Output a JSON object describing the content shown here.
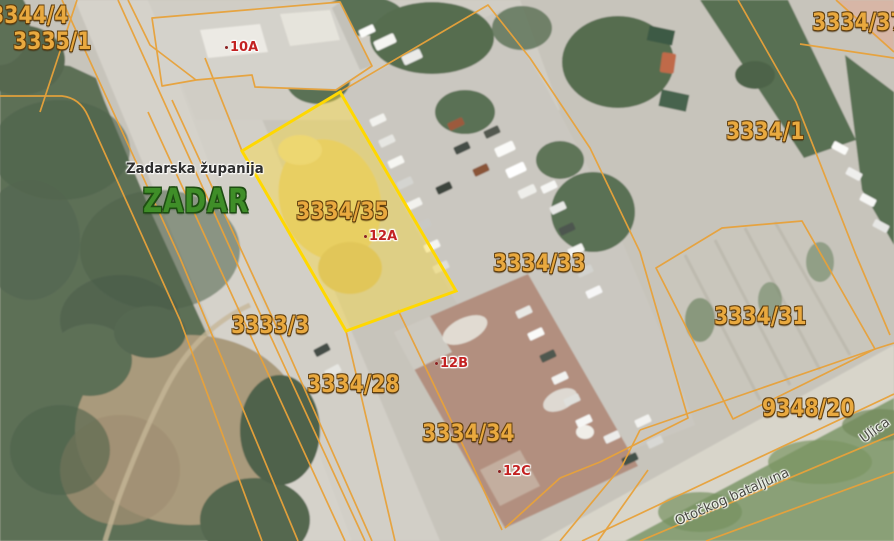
{
  "labels": {
    "county": "Zadarska županija",
    "city": "ZADAR",
    "parcels": [
      "3344/4",
      "3335/1",
      "3334/37",
      "3334/1",
      "3334/35",
      "3334/33",
      "3334/31",
      "9348/20",
      "3333/3",
      "3334/28",
      "3334/34"
    ],
    "addresses": [
      "10A",
      "12A",
      "12B",
      "12C"
    ],
    "streets": [
      "Otočkog bataljuna",
      "Ulica"
    ]
  },
  "selected_parcel": "3334/35",
  "colors": {
    "cadastral_line": "#e8a23a",
    "selected_parcel_border": "#ffd800",
    "selected_parcel_fill": "rgba(255,222,60,0.42)",
    "parcel_label": "#e9a93f",
    "parcel_label_outline": "#5f3d0c",
    "address_label": "#c32222",
    "city_label": "#3f8e28",
    "county_label": "#2f2f2f",
    "street_label": "#4b4b44"
  }
}
